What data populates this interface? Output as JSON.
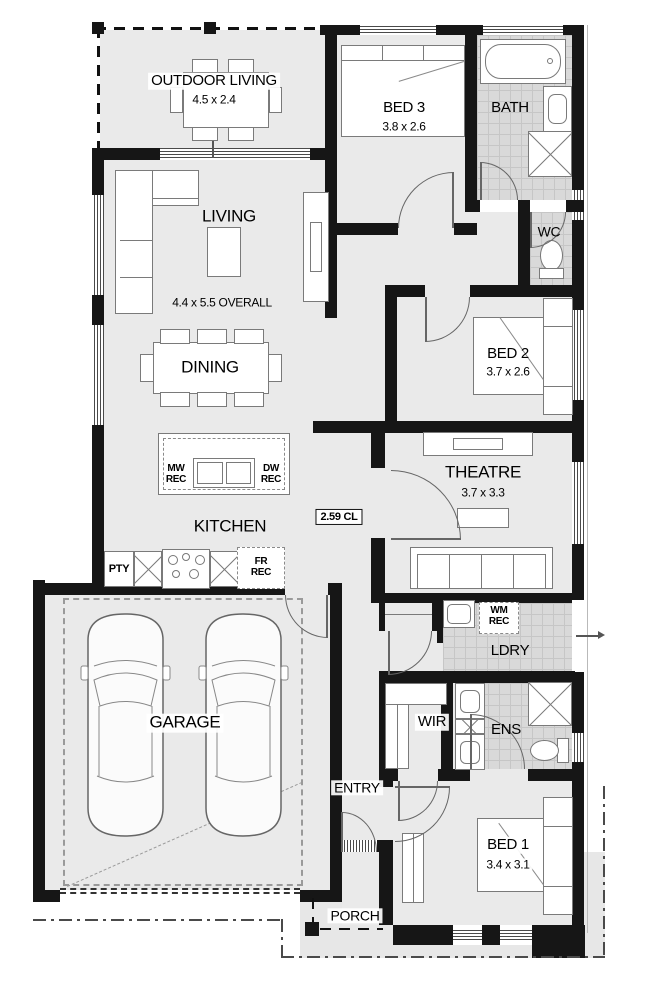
{
  "plan": {
    "title": "single-storey house floor plan",
    "rooms": {
      "outdoor_living": {
        "name": "OUTDOOR LIVING",
        "dim": "4.5 x 2.4"
      },
      "bed3": {
        "name": "BED 3",
        "dim": "3.8 x 2.6"
      },
      "bath": {
        "name": "BATH"
      },
      "wc": {
        "name": "WC"
      },
      "living": {
        "name": "LIVING",
        "dim": "4.4 x 5.5 OVERALL"
      },
      "dining": {
        "name": "DINING"
      },
      "bed2": {
        "name": "BED 2",
        "dim": "3.7 x 2.6"
      },
      "theatre": {
        "name": "THEATRE",
        "dim": "3.7 x 3.3"
      },
      "kitchen": {
        "name": "KITCHEN"
      },
      "garage": {
        "name": "GARAGE"
      },
      "ldry": {
        "name": "LDRY"
      },
      "wir": {
        "name": "WIR"
      },
      "ens": {
        "name": "ENS"
      },
      "entry": {
        "name": "ENTRY"
      },
      "bed1": {
        "name": "BED 1",
        "dim": "3.4 x 3.1"
      },
      "porch": {
        "name": "PORCH"
      }
    },
    "annotations": {
      "ceiling_height": "2.59 CL",
      "pantry": "PTY",
      "mw_rec": "MW\nREC",
      "dw_rec": "DW\nREC",
      "fr_rec": "FR\nREC",
      "wm_rec": "WM\nREC"
    },
    "colors": {
      "wall": "#161616",
      "floor": "#eaeaea",
      "tile": "#d9d9d9",
      "porch_slab": "#e7e7e7"
    }
  }
}
